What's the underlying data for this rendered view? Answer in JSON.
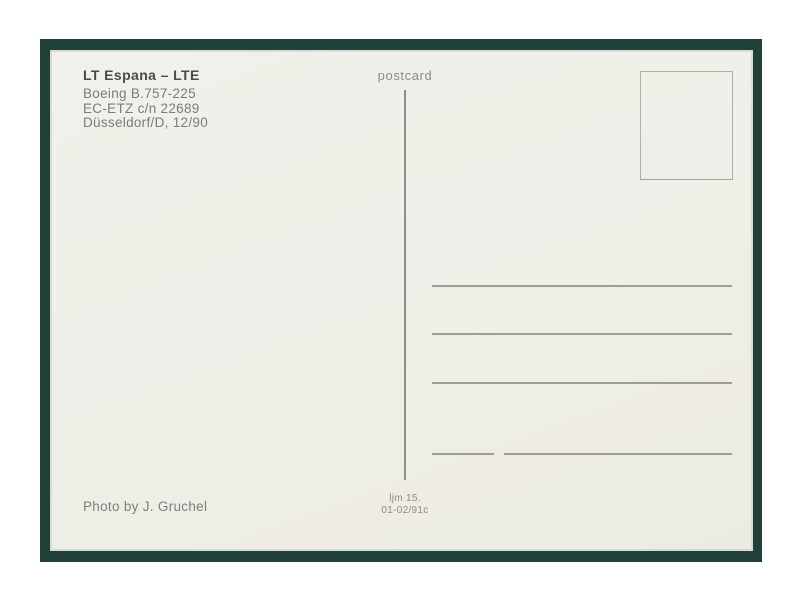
{
  "colors": {
    "page_background": "#ffffff",
    "mount_frame_green": "#22403a",
    "paper_cream": "#efeee7",
    "rule_line_gray": "#9d9c95",
    "divider_gray": "#8f8e88",
    "stamp_border_gray": "#b0afa8",
    "caption_title_gray": "#4c4b46",
    "caption_text_gray": "#7c7b74"
  },
  "postcard_back": {
    "caption": {
      "title": "LT Espana – LTE",
      "lines": [
        "Boeing B.757-225",
        "EC-ETZ c/n 22689",
        "Düsseldorf/D, 12/90"
      ]
    },
    "type_label": "postcard",
    "address_area": {
      "full_line_count": 3,
      "split_bottom_line": true
    },
    "footer": {
      "photo_credit": "Photo by J. Gruchel",
      "publisher_code": [
        "ljm 15.",
        "01-02/91c"
      ]
    }
  }
}
